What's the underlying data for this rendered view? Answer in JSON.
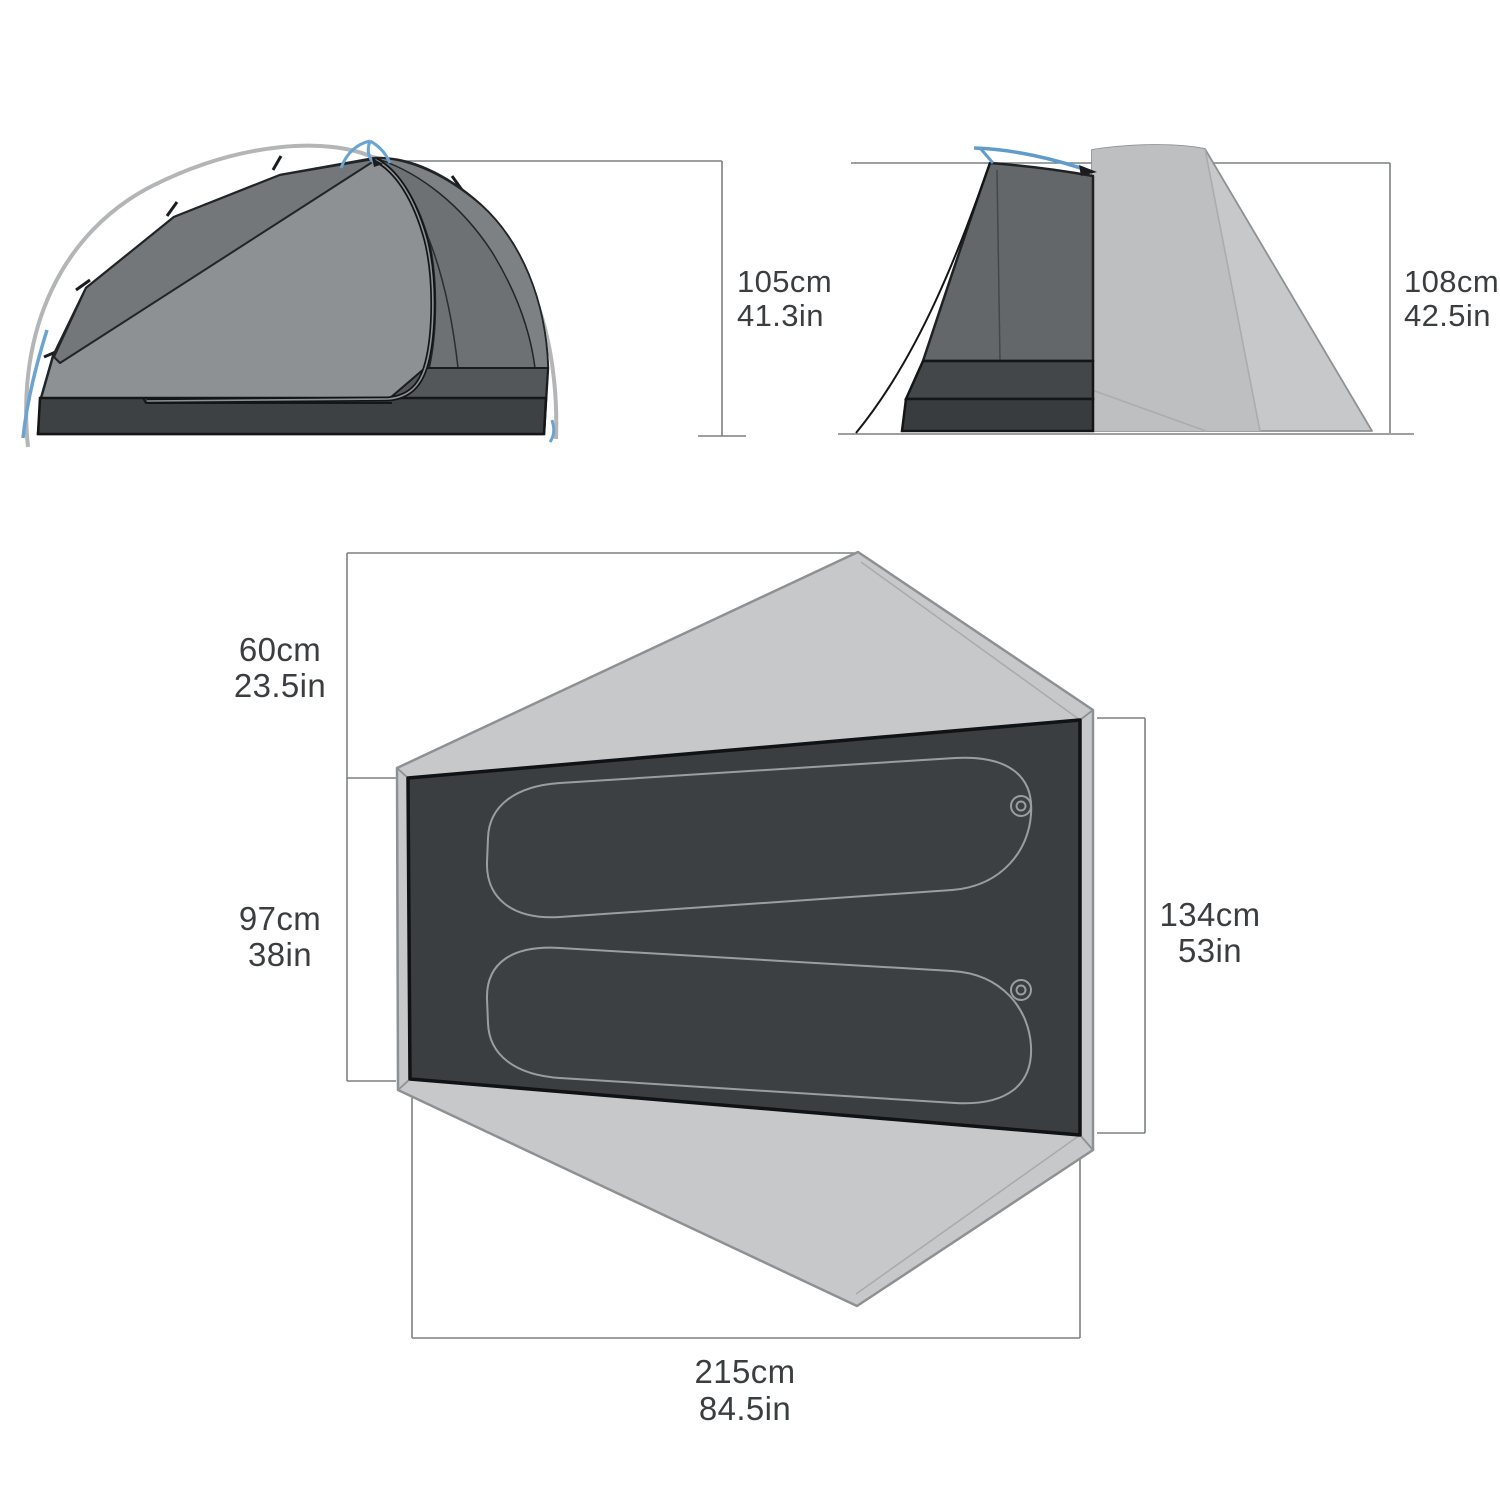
{
  "page": {
    "kind": "tent specification dimension diagram",
    "background": "#ffffff"
  },
  "colors": {
    "accent_blue": "#6ca3d1",
    "canopy_grey": "#8e9194",
    "canopy_dark_panel": "#74777a",
    "inner_mesh_grey": "#64676a",
    "floor_dark": "#3b3e41",
    "bathtub_band": "#44474a",
    "fly_light": "#c6c8c9",
    "pad_outline": "#9b9ea0",
    "dimension_line": "#7d8082",
    "label_text": "#3b3e40"
  },
  "labels": {
    "side_height_cm": "105cm",
    "side_height_in": "41.3in",
    "front_height_cm": "108cm",
    "front_height_in": "42.5in",
    "vestibule_cm": "60cm",
    "vestibule_in": "23.5in",
    "left_width_cm": "97cm",
    "left_width_in": "38in",
    "right_width_cm": "134cm",
    "right_width_in": "53in",
    "length_cm": "215cm",
    "length_in": "84.5in"
  },
  "dimensions": [
    {
      "part": "peak-height-side-view",
      "metric": "105cm",
      "imperial": "41.3in"
    },
    {
      "part": "peak-height-front-view",
      "metric": "108cm",
      "imperial": "42.5in"
    },
    {
      "part": "vestibule-depth",
      "metric": "60cm",
      "imperial": "23.5in"
    },
    {
      "part": "floor-width-foot-end",
      "metric": "97cm",
      "imperial": "38in"
    },
    {
      "part": "floor-width-head-end",
      "metric": "134cm",
      "imperial": "53in"
    },
    {
      "part": "floor-length",
      "metric": "215cm",
      "imperial": "84.5in"
    }
  ]
}
